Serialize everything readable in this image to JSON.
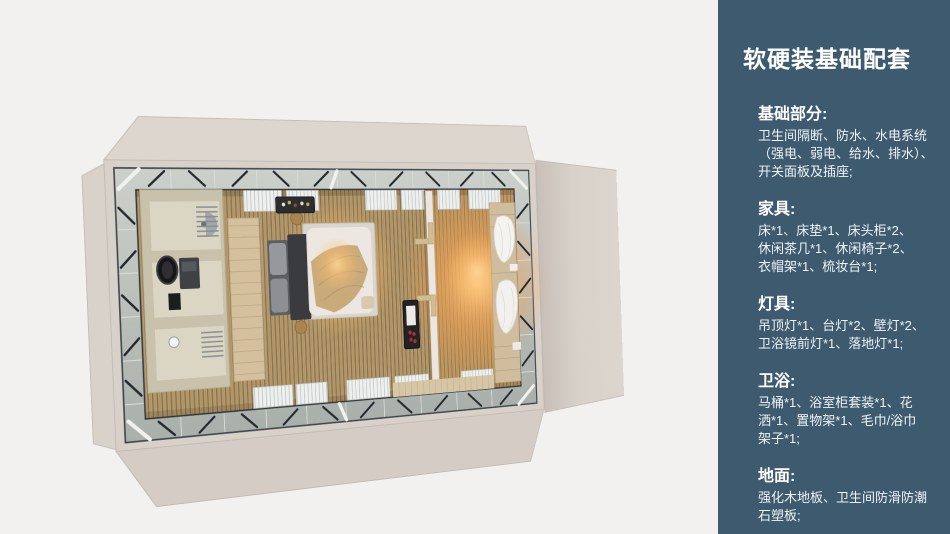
{
  "page": {
    "background": "#f2f1ef"
  },
  "floorplan": {
    "type": "top-down 3D room render",
    "colors": {
      "shell": "#d8d1ca",
      "frame_band": "#bfc5c0",
      "truss": "#23282e",
      "floor_wood": "#b59a6c",
      "warm_glow": "#ffb45f",
      "bathroom_wall": "#c8c1ab",
      "rug": "#d9d6d0",
      "bedding": "#ece8e1",
      "knit_throw": "#c9ab7b",
      "headboard": "#3a3b3f",
      "wood_panel": "#d5c09d",
      "minibar": "#232326"
    },
    "items": [
      "bathroom",
      "shower",
      "vanity-mirror",
      "toilet",
      "towel-radiators",
      "wood-slat-panel",
      "double-bed",
      "rug",
      "bar-shelf",
      "side-tables",
      "divider-wall",
      "wall-shelves",
      "minibar",
      "right-bed",
      "curtains",
      "slatted-panels"
    ]
  },
  "sidebar": {
    "background": "#3d5a6e",
    "text_color": "#ffffff",
    "title": "软硬装基础配套",
    "sections": [
      {
        "heading": "基础部分:",
        "lines": [
          "卫生间隔断、防水、水电系统",
          "（强电、弱电、给水、排水）、",
          "开关面板及插座;"
        ]
      },
      {
        "heading": "家具:",
        "lines": [
          "床*1、床垫*1、床头柜*2、",
          "休闲茶几*1、休闲椅子*2、",
          "衣帽架*1、梳妆台*1;"
        ]
      },
      {
        "heading": "灯具:",
        "lines": [
          "吊顶灯*1、台灯*2、壁灯*2、",
          "卫浴镜前灯*1、落地灯*1;"
        ]
      },
      {
        "heading": "卫浴:",
        "lines": [
          "马桶*1、浴室柜套装*1、花",
          "洒*1、置物架*1、毛巾/浴巾",
          "架子*1;"
        ]
      },
      {
        "heading": "地面:",
        "lines": [
          "强化木地板、卫生间防滑防潮",
          "石塑板;"
        ]
      }
    ]
  }
}
